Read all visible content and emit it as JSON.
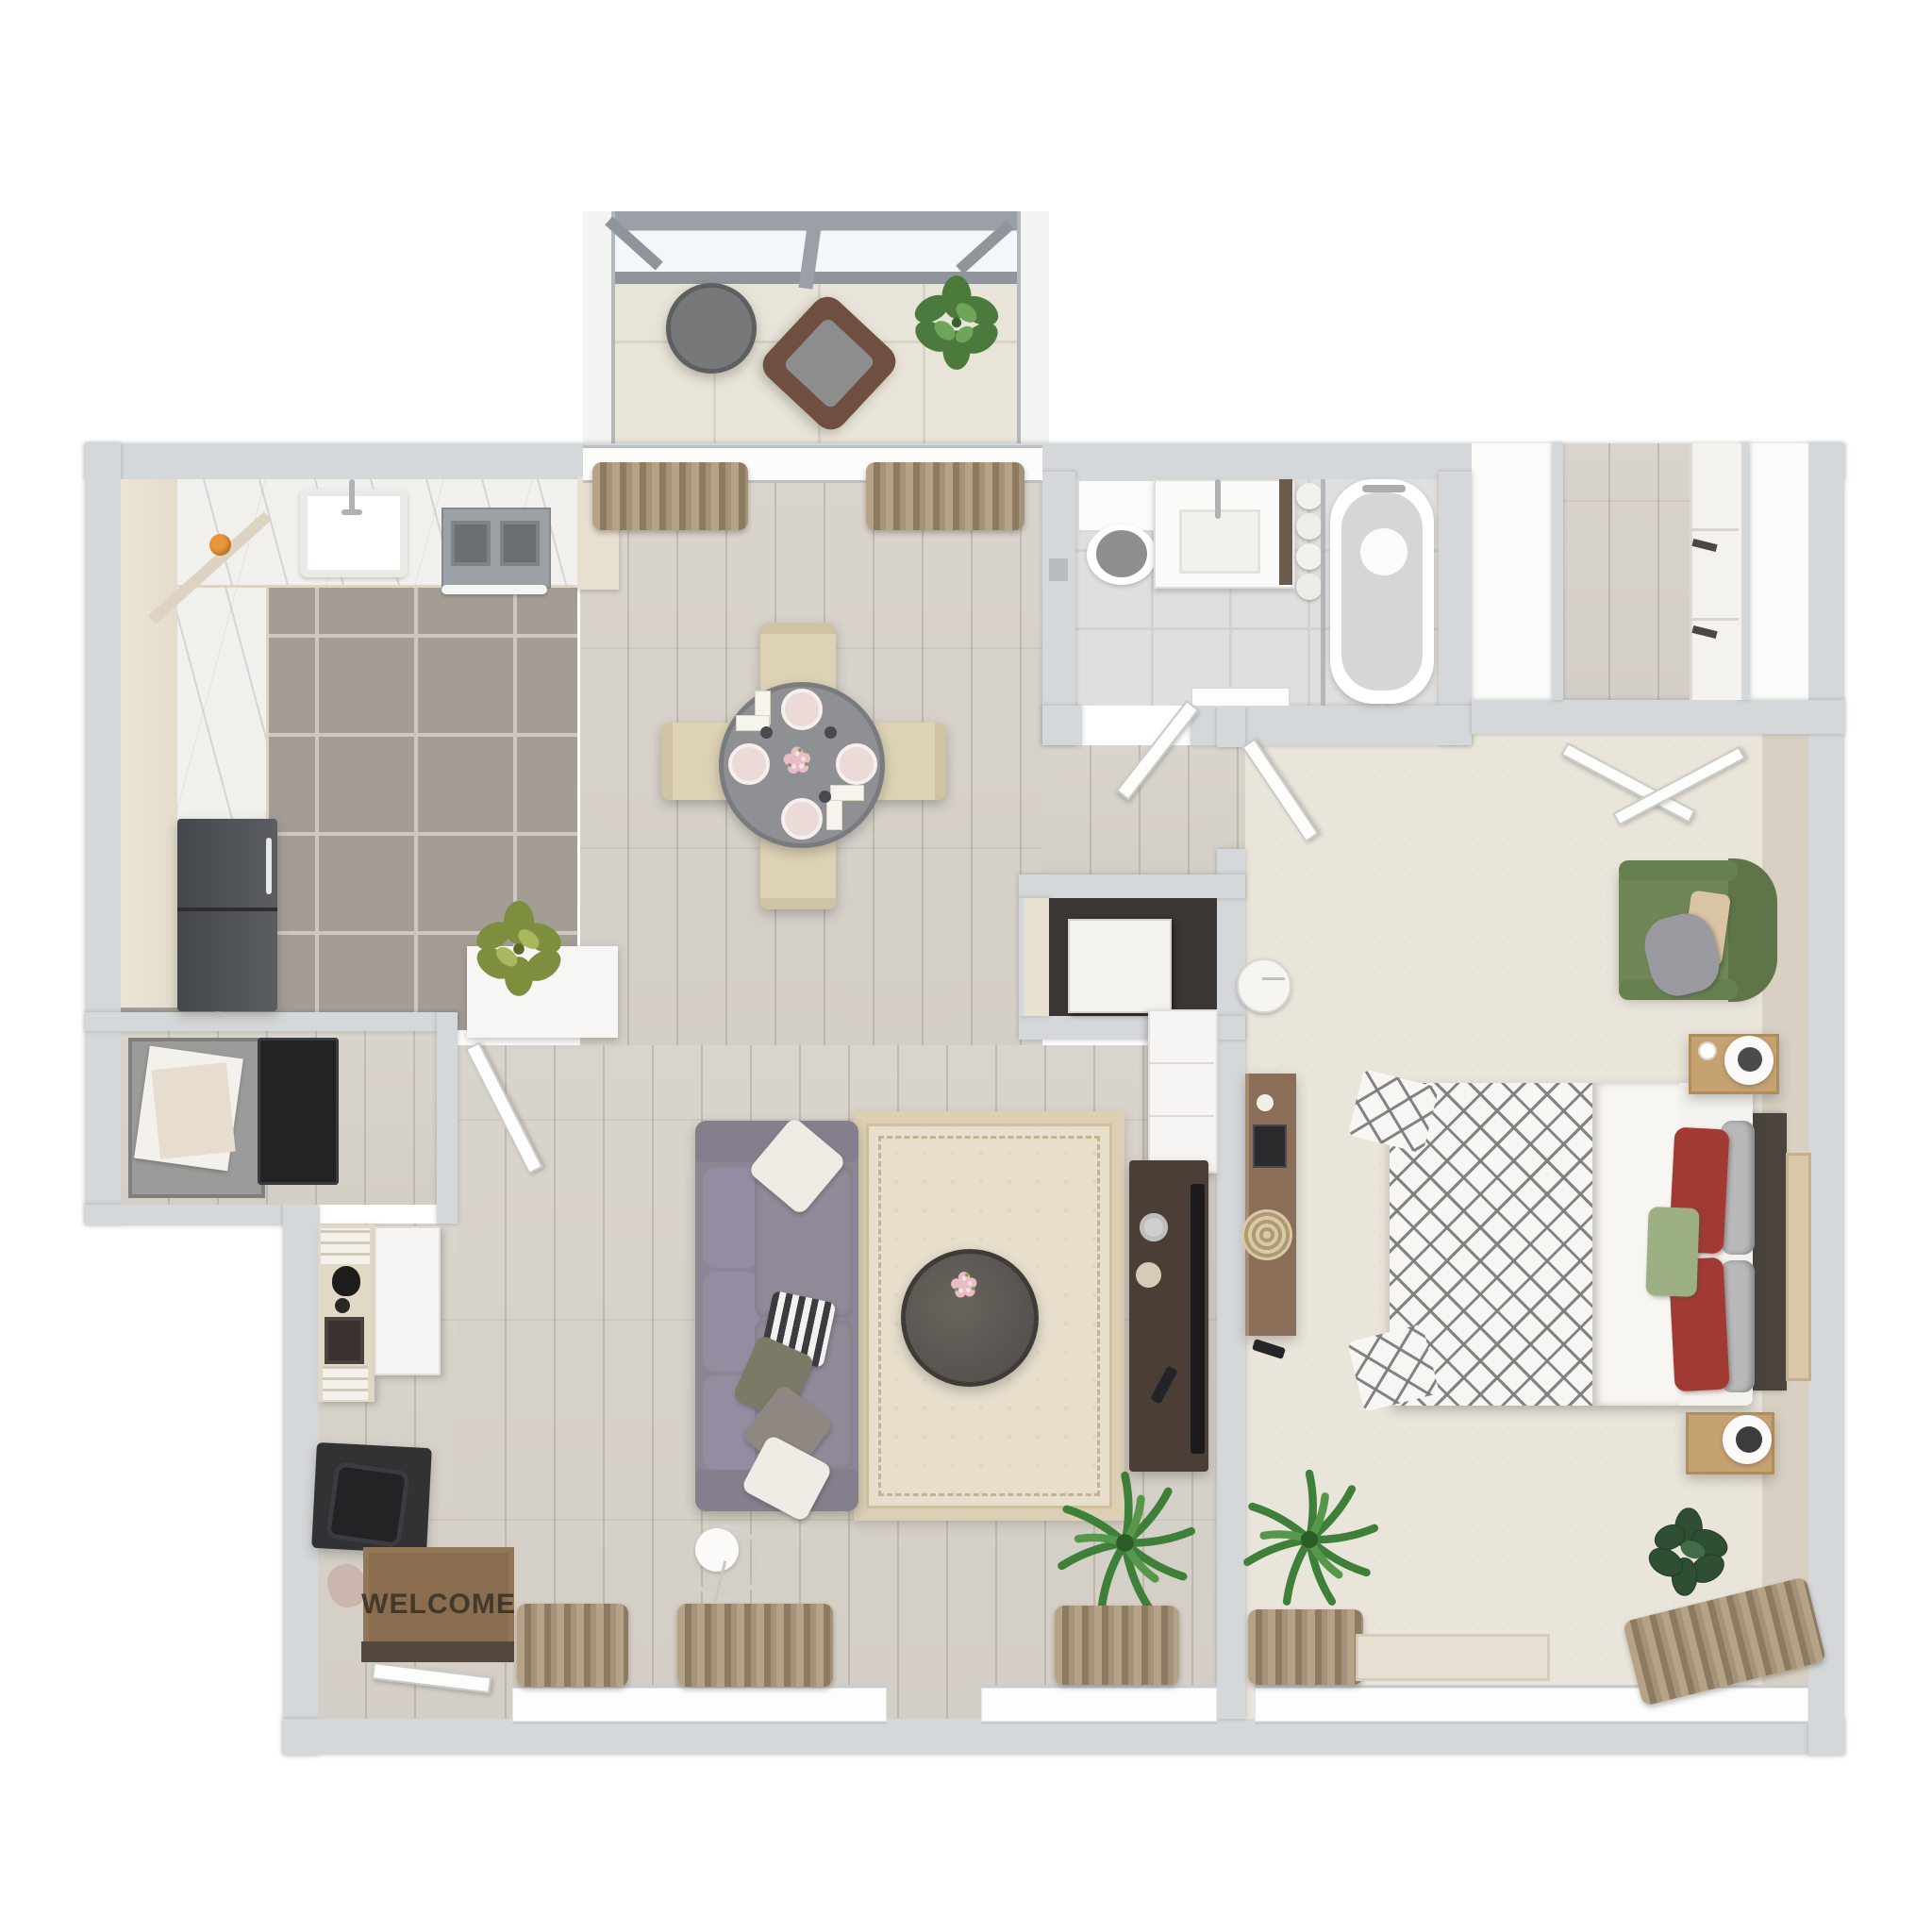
{
  "scene": {
    "kind": "3d-floor-plan-top-view",
    "apartment": "one-bedroom apartment with screened balcony"
  },
  "labels": {
    "welcome_mat": "WELCOME"
  },
  "palette": {
    "background": "#ffffff",
    "wall": "#d5d8da",
    "wood_floor": "#d6d1c9",
    "kitchen_tile": "#a39d95",
    "bath_tile": "#e0dfdd",
    "balcony_tile": "#e9e4d8",
    "carpet": "#eae5db",
    "marble_counter": "#f2f0ec",
    "curtain": "#a5927a",
    "sofa": "#8c8593",
    "rug": "#e7dfcc",
    "bed_red_pillow": "#a23a34",
    "bed_green_pillow": "#9cb084",
    "armchair_green": "#6f8757",
    "welcome_mat": "#8a6d4e",
    "plant_green": "#3e8039",
    "media_console": "#4a3e36",
    "refrigerator": "#53565a"
  },
  "rooms": [
    {
      "id": "balcony",
      "items": [
        "round-side-table",
        "lounge-chair",
        "potted-plant",
        "screen-frame"
      ]
    },
    {
      "id": "kitchen",
      "items": [
        "sink",
        "faucet",
        "stove",
        "oven-handle",
        "refrigerator",
        "marble-counter",
        "orange-fruit",
        "planter-plant"
      ]
    },
    {
      "id": "dining-area",
      "items": [
        "round-dining-table",
        "dining-chair-x4",
        "place-setting-x4",
        "flower-centerpiece",
        "window-curtains"
      ]
    },
    {
      "id": "bathroom",
      "items": [
        "toilet",
        "vanity-sink",
        "bathtub",
        "tub-faucet",
        "shower-glass",
        "towel-roll-stack",
        "bath-mat",
        "door"
      ]
    },
    {
      "id": "walk-in-closet",
      "items": [
        "built-in-drawers",
        "drawer-handles",
        "double-swing-doors"
      ]
    },
    {
      "id": "laundry-closet",
      "items": [
        "linen-basket",
        "washer",
        "closet-door"
      ]
    },
    {
      "id": "utility-closet",
      "items": [
        "water-heater"
      ]
    },
    {
      "id": "living-room",
      "items": [
        "sofa",
        "throw-pillows",
        "area-rug",
        "round-coffee-table",
        "floor-lamp",
        "palm-plant",
        "tv-console",
        "tv-panel",
        "storage-cabinet",
        "desk",
        "desk-chair",
        "entry-shelf",
        "welcome-mat",
        "entry-door",
        "window-curtains"
      ]
    },
    {
      "id": "bedroom",
      "items": [
        "double-bed",
        "diamond-pattern-duvet",
        "red-pillows",
        "gray-pillows",
        "green-accent-pillow",
        "headboard",
        "nightstand",
        "table-lamp",
        "side-table",
        "green-armchair",
        "throw-blanket",
        "wall-dresser",
        "robot-vacuum",
        "palm-plant",
        "rubber-plant",
        "leaning-wall-art",
        "door",
        "window-curtains",
        "door-mat"
      ]
    }
  ]
}
